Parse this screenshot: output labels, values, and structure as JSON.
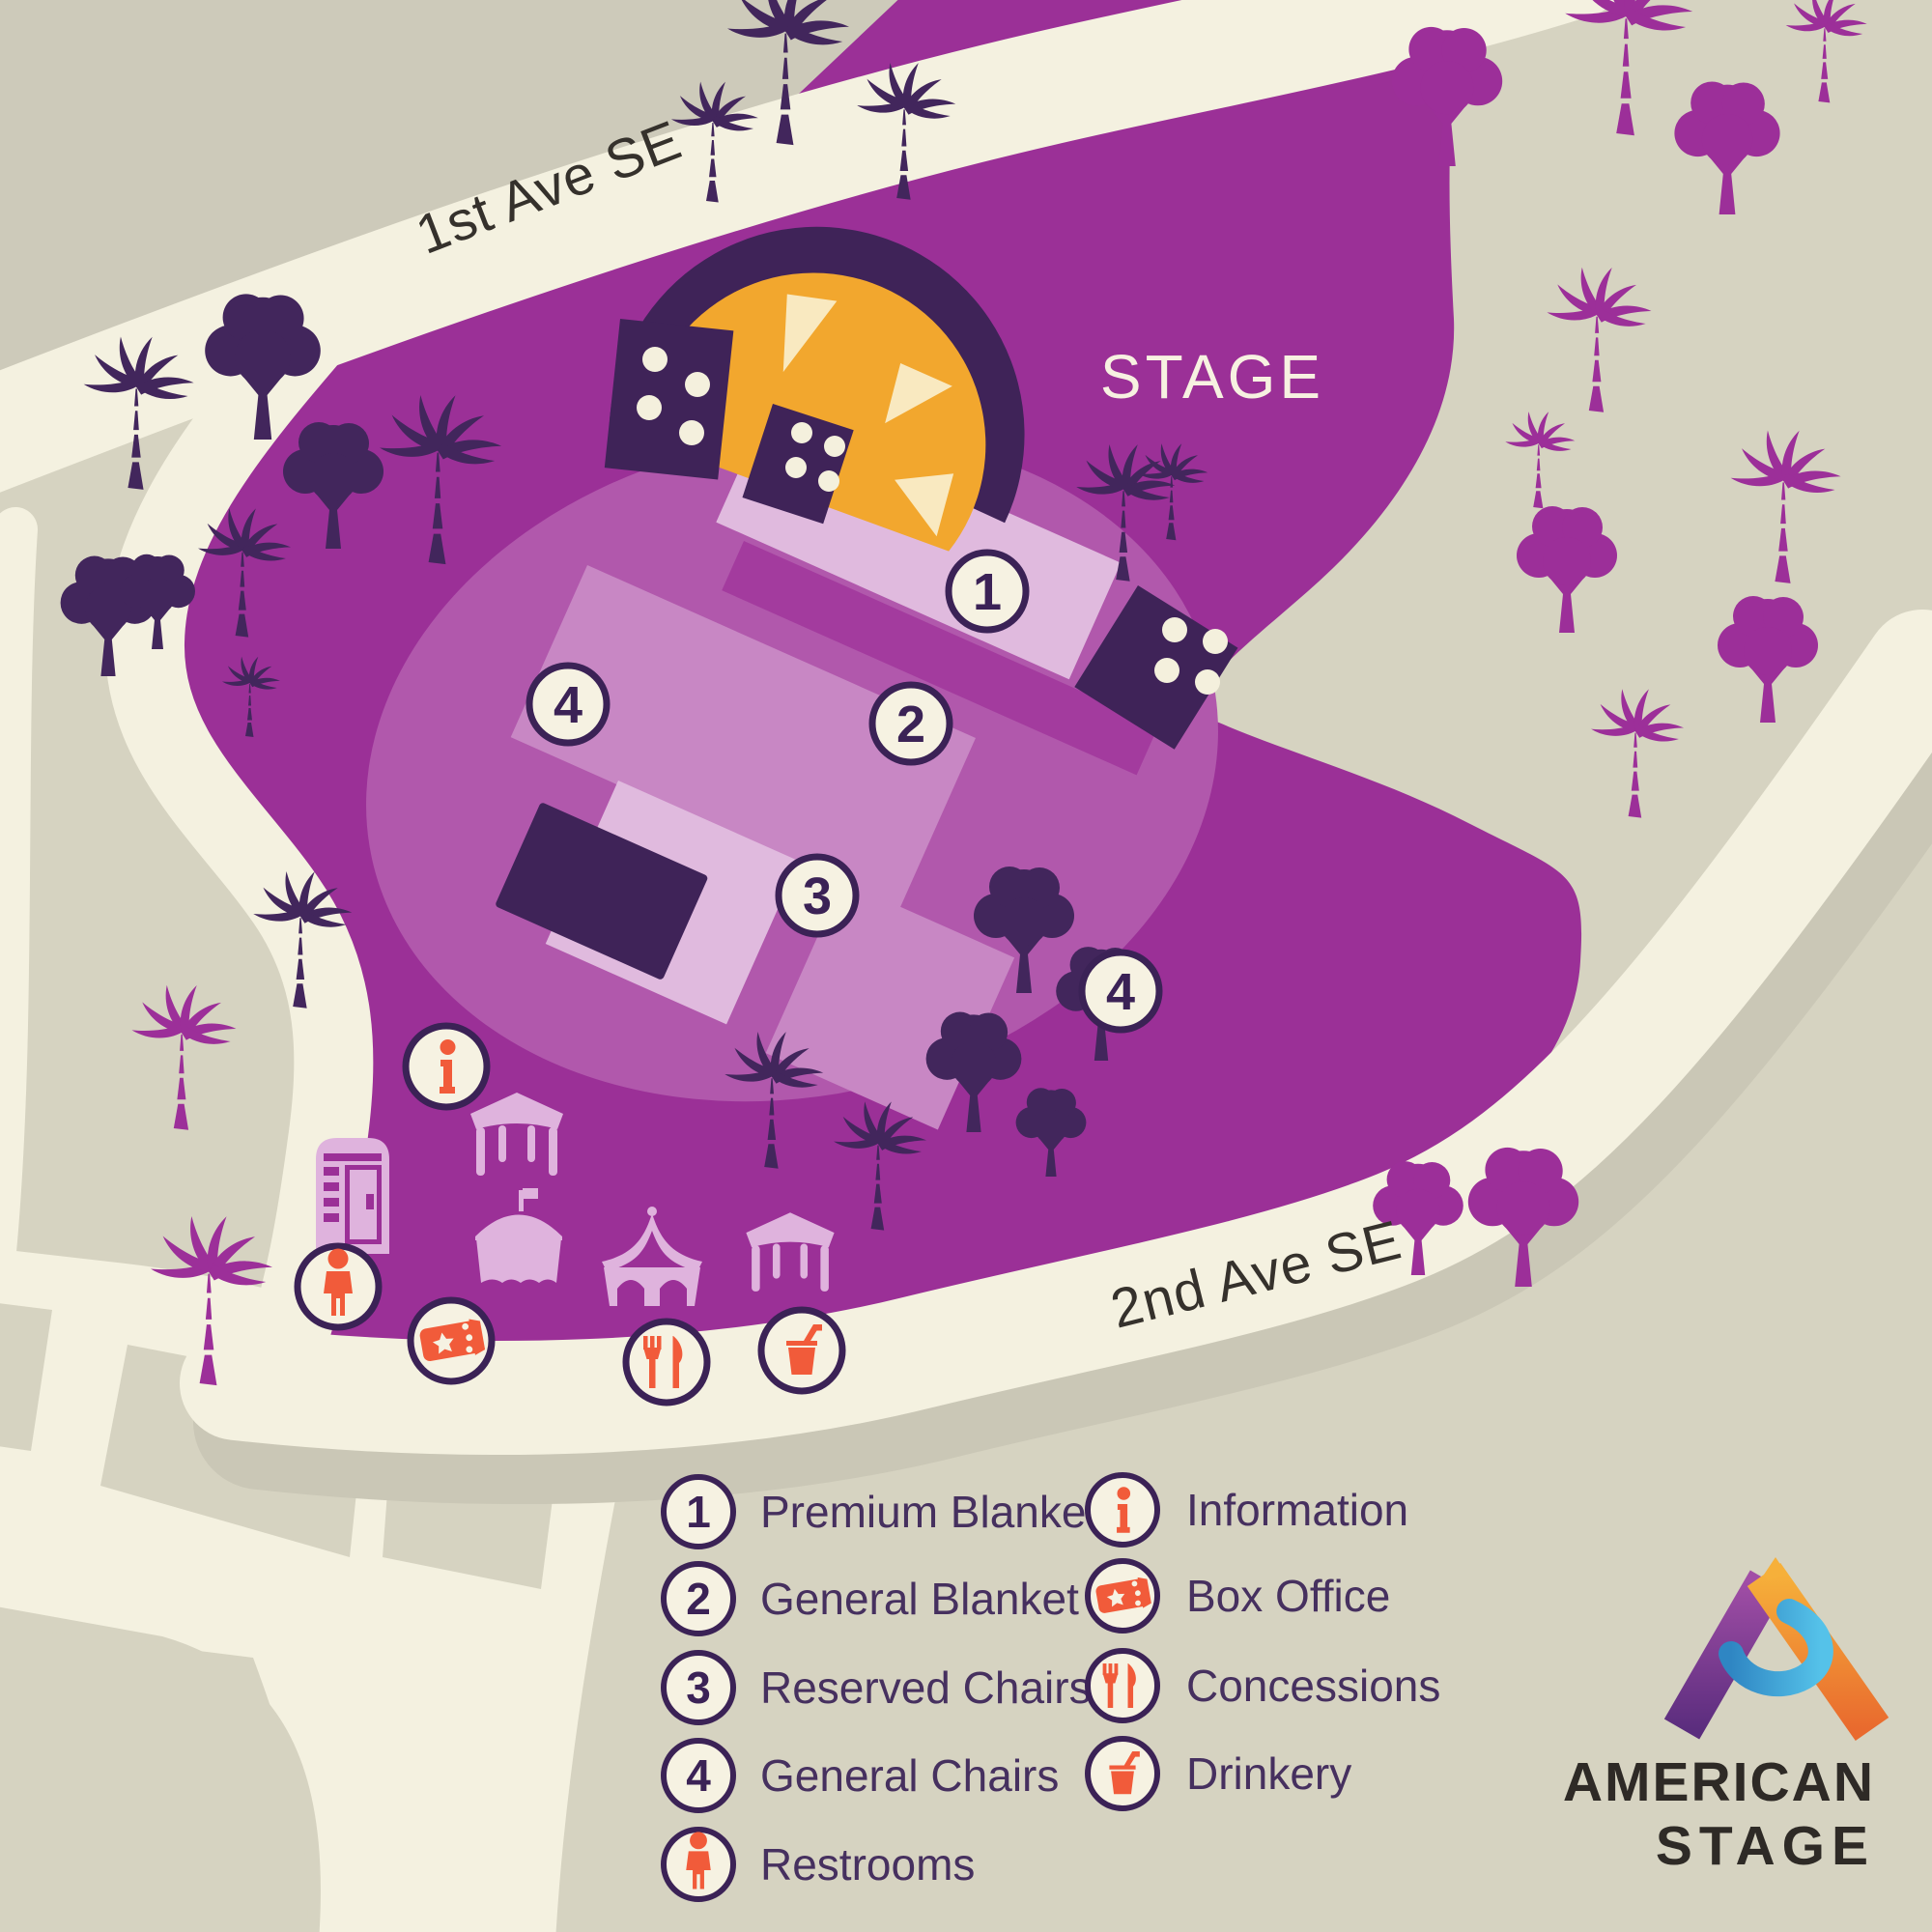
{
  "map": {
    "streets": {
      "first_ave": "1st Ave SE",
      "second_ave": "2nd Ave SE"
    },
    "stage_label": "STAGE",
    "zone_markers": [
      "1",
      "2",
      "3",
      "4",
      "4"
    ],
    "colors": {
      "background_beige": "#d6d3c1",
      "road_cream": "#f4f1e0",
      "park_purple": "#9b3097",
      "seating_ellipse": "#b158ac",
      "seating_medium": "#c887c4",
      "seating_light": "#e0bade",
      "aisle_purple": "#a33b9e",
      "dark_purple": "#42265c",
      "stage_orange": "#f2a72e",
      "stage_highlight": "#f9e9c0",
      "icon_orange": "#f15b3a",
      "circle_cream": "#f6f2e2",
      "tent_pink": "#dfb3dd"
    }
  },
  "legend": {
    "seating": [
      {
        "num": "1",
        "label": "Premium Blanket"
      },
      {
        "num": "2",
        "label": "General Blanket"
      },
      {
        "num": "3",
        "label": "Reserved Chairs"
      },
      {
        "num": "4",
        "label": "General Chairs"
      },
      {
        "num": "",
        "label": "Restrooms"
      }
    ],
    "amenities": [
      {
        "label": "Information"
      },
      {
        "label": "Box Office"
      },
      {
        "label": "Concessions"
      },
      {
        "label": "Drinkery"
      }
    ]
  },
  "logo": {
    "line1": "AMERICAN",
    "line2": "STAGE"
  }
}
